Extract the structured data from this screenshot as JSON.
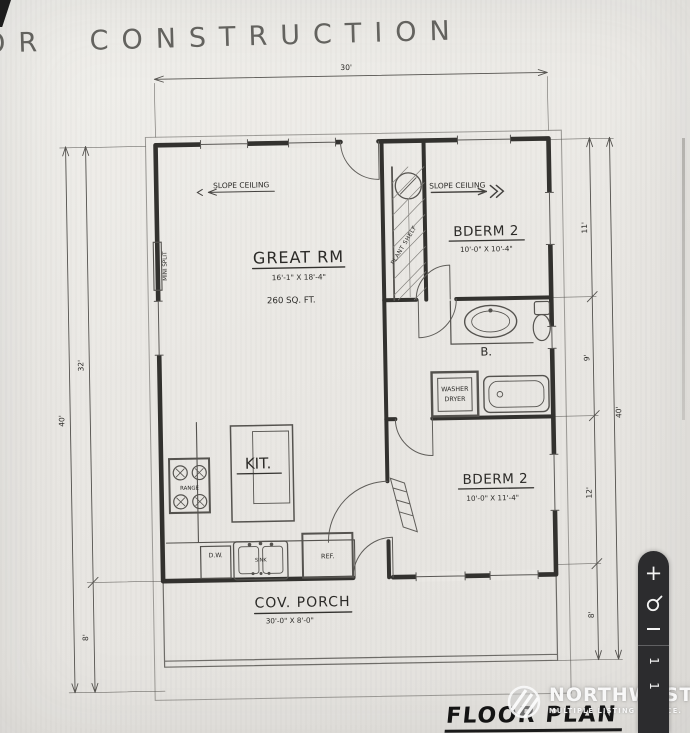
{
  "sheet": {
    "title_fragment": "OR CONSTRUCTION",
    "caption": "FLOOR PLAN"
  },
  "dimensions": {
    "top_width": "30'",
    "left_upper": "32'",
    "left_total": "40'",
    "left_porch": "8'",
    "right_bedroom2_top": "11'",
    "right_bath": "9'",
    "right_bedroom2_bottom": "12'",
    "right_porch": "8'",
    "right_total": "40'"
  },
  "rooms": {
    "great_room": {
      "name": "GREAT RM",
      "size": "16'-1\" X 18'-4\"",
      "area": "260 SQ. FT."
    },
    "bedroom_top": {
      "name": "BDERM 2",
      "size": "10'-0\" X 10'-4\""
    },
    "bedroom_bottom": {
      "name": "BDERM 2",
      "size": "10'-0\" X 11'-4\""
    },
    "bath": {
      "name": "B."
    },
    "kitchen": {
      "name": "KIT."
    },
    "porch": {
      "name": "COV. PORCH",
      "size": "30'-0\" X 8'-0\""
    }
  },
  "annotations": {
    "slope_ceiling": "SLOPE CEILING",
    "mini_split": "MINI SPLIT",
    "plant_shelf": "PLANT SHELF",
    "range": "RANGE",
    "dishwasher": "D.W.",
    "sink": "SINK",
    "refrigerator": "REF.",
    "washer": "WASHER",
    "dryer": "DRYER"
  },
  "watermark": {
    "line1": "NORTHWEST",
    "line2": "MULTIPLE LISTING SERVICE."
  },
  "toolbar": {
    "zoom_in_label": "+",
    "page_current": "1",
    "page_total": "1"
  },
  "colors": {
    "ink": "#33322f",
    "paper": "#eae8e4",
    "toolbar_bg": "#2c2c2e",
    "toolbar_fg": "#f4f4f4"
  }
}
